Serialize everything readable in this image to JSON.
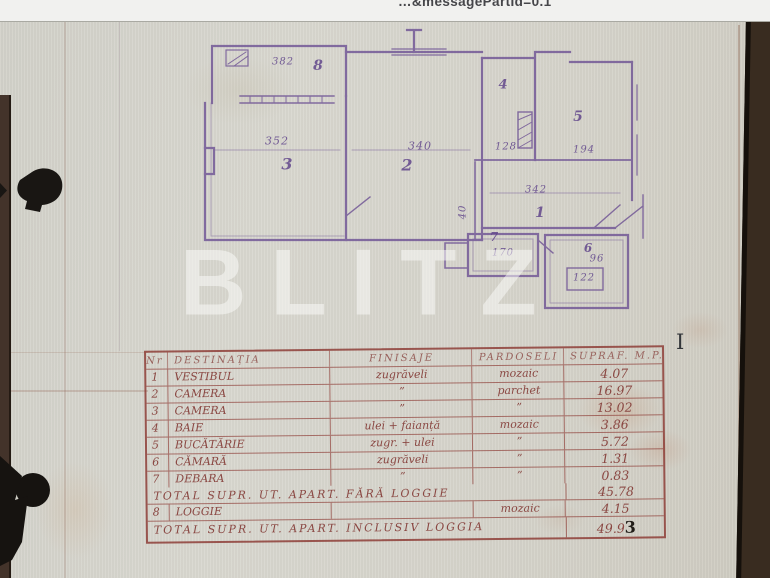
{
  "page": {
    "url_fragment": "…&messagePartId=0.1",
    "watermark_text": "BLITZ",
    "text_cursor_glyph": "I"
  },
  "colors": {
    "paper": "#d7d5cc",
    "plan_ink": "#6a4d92",
    "table_ink": "#8d4340",
    "photo_background": "#3a2d22",
    "watermark": "#fbfbf9"
  },
  "floor_plan": {
    "rooms": [
      {
        "number": "8",
        "dimension": "382"
      },
      {
        "number": "3",
        "dimension": "352"
      },
      {
        "number": "2",
        "dimension": "340"
      },
      {
        "number": "4",
        "dimension": "128"
      },
      {
        "number": "5",
        "dimension": "194"
      },
      {
        "number": "1",
        "dimension": "342"
      },
      {
        "number": "7",
        "dimension": "170"
      },
      {
        "number": "6",
        "dimension": "122"
      }
    ],
    "extra_dimensions": [
      "96",
      "40"
    ]
  },
  "table": {
    "headers": [
      "Nr",
      "DESTINAȚIA",
      "FINISAJE",
      "PARDOSELI",
      "SUPRAF. M.P."
    ],
    "rows": [
      {
        "nr": "1",
        "destinatia": "VESTIBUL",
        "finisaje": "zugrăveli",
        "pardoseli": "mozaic",
        "suprafata": "4.07"
      },
      {
        "nr": "2",
        "destinatia": "CAMERA",
        "finisaje": "”",
        "pardoseli": "parchet",
        "suprafata": "16.97"
      },
      {
        "nr": "3",
        "destinatia": "CAMERA",
        "finisaje": "”",
        "pardoseli": "”",
        "suprafata": "13.02"
      },
      {
        "nr": "4",
        "destinatia": "BAIE",
        "finisaje": "ulei + faianță",
        "pardoseli": "mozaic",
        "suprafata": "3.86"
      },
      {
        "nr": "5",
        "destinatia": "BUCĂTĂRIE",
        "finisaje": "zugr. + ulei",
        "pardoseli": "”",
        "suprafata": "5.72"
      },
      {
        "nr": "6",
        "destinatia": "CĂMARĂ",
        "finisaje": "zugrăveli",
        "pardoseli": "”",
        "suprafata": "1.31"
      },
      {
        "nr": "7",
        "destinatia": "DEBARA",
        "finisaje": "”",
        "pardoseli": "”",
        "suprafata": "0.83"
      }
    ],
    "total_without_loggia": {
      "label": "TOTAL SUPR. UT. APART. FĂRĂ LOGGIE",
      "value": "45.78"
    },
    "loggia_row": {
      "nr": "8",
      "destinatia": "LOGGIE",
      "finisaje": "",
      "pardoseli": "mozaic",
      "suprafata": "4.15"
    },
    "total_with_loggia": {
      "label": "TOTAL SUPR. UT. APART. INCLUSIV LOGGIA",
      "value": "49.9",
      "value_overwritten": "3"
    }
  }
}
